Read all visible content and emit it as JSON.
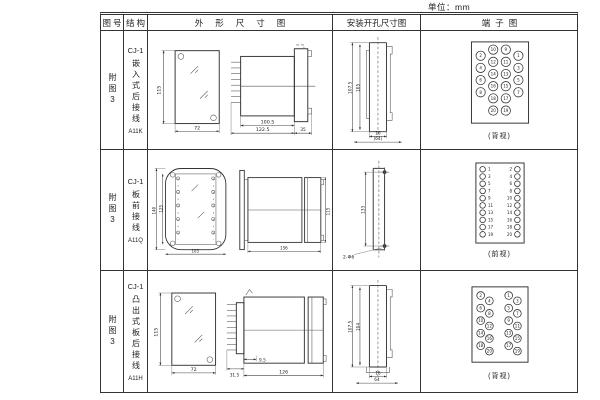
{
  "unit_label": "单位：mm",
  "header": {
    "figure": "图号",
    "structure": "结构",
    "outline": "外形尺寸图",
    "mounting": "安装开孔尺寸图",
    "terminal": "端子图"
  },
  "rows": [
    {
      "figure": "附图3",
      "model": "CJ-1",
      "structure": "嵌入式后接线",
      "code": "A11K",
      "outline": {
        "front_h": "115",
        "front_w": "72",
        "side_d1": "100.5",
        "side_d2": "122.5",
        "side_d3": "35"
      },
      "mounting": {
        "v_outer": "107.5",
        "v_inner": "105",
        "h_inner": "16",
        "h_outer": "(64)"
      },
      "terminal": {
        "caption": "(背视)",
        "layout": "grid4",
        "columns": [
          [
            2,
            4,
            6,
            8
          ],
          [
            10,
            12,
            14,
            16,
            18,
            20
          ],
          [
            9,
            11,
            13,
            15,
            17,
            19
          ],
          [
            1,
            3,
            5,
            7
          ]
        ]
      }
    },
    {
      "figure": "附图3",
      "model": "CJ-1",
      "structure": "板前接线",
      "code": "A11Q",
      "outline": {
        "front_h": "140",
        "front_h2": "125",
        "front_w": "105",
        "side_d1": "156",
        "side_h": "115"
      },
      "mounting": {
        "v_dim": "133",
        "hole_label": "2-Φ6"
      },
      "terminal": {
        "caption": "(前视)",
        "layout": "cols2",
        "columns": [
          [
            1,
            3,
            5,
            7,
            9,
            11,
            13,
            15,
            17,
            19
          ],
          [
            2,
            4,
            6,
            8,
            10,
            12,
            14,
            16,
            18,
            20
          ]
        ]
      }
    },
    {
      "figure": "附图3",
      "model": "CJ-1",
      "structure": "凸出式板后接线",
      "code": "A11H",
      "outline": {
        "front_h": "115",
        "front_w": "72",
        "side_d1": "31.5",
        "side_d2": "9.5",
        "side_d3": "126"
      },
      "mounting": {
        "v_outer": "107.5",
        "v_inner": "104",
        "h_inner": "16",
        "h_outer": "64"
      },
      "terminal": {
        "caption": "(背视)",
        "layout": "stagger",
        "columns": [
          [
            2,
            4,
            6,
            8,
            10,
            12,
            14,
            16,
            18,
            20
          ],
          [
            1,
            3,
            5,
            7,
            9,
            11,
            13,
            15,
            17,
            19
          ]
        ]
      }
    }
  ]
}
